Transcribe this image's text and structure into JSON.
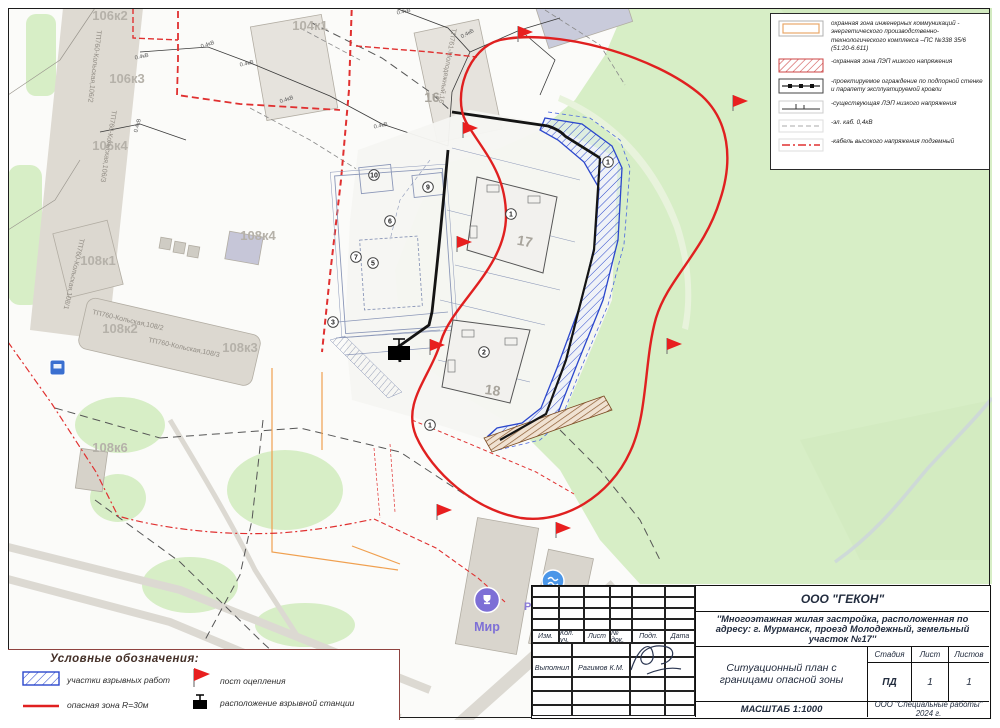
{
  "colors": {
    "danger_zone_red": "#e02020",
    "blast_area_blue": "#2b47cc",
    "park_green": "#d7eec6",
    "map_label_grey": "#b5b1a9"
  },
  "legend_top": {
    "items": [
      {
        "symbol": "utility-protection-zone",
        "label": "охранная зона инженерных коммуникаций - энергетического производственно-технологического комплекса –ПС №338 35/6 (51:20-6.611)"
      },
      {
        "symbol": "lep-low-voltage-zone",
        "label": "-охранная зона ЛЭП низкого напряжения"
      },
      {
        "symbol": "designed-fence",
        "label": "-проектируемое ограждение по подпорной стенке и парапету эксплуатируемой кровли"
      },
      {
        "symbol": "existing-lep",
        "label": "-существующая ЛЭП низкого напряжения"
      },
      {
        "symbol": "el-cable",
        "label": "-эл. каб. 0,4кВ"
      },
      {
        "symbol": "hv-underground-cable",
        "label": "-кабель высокого напряжения подземный"
      }
    ]
  },
  "legend_bottom": {
    "title": "Условные обозначения:",
    "items": [
      {
        "symbol": "blast-work-area",
        "label": "участки взрывных работ"
      },
      {
        "symbol": "danger-zone-line",
        "label": "опасная зона R=30м"
      },
      {
        "symbol": "cordon-post-flag",
        "label": "пост оцепления"
      },
      {
        "symbol": "blast-station",
        "label": "расположение взрывной станции"
      }
    ]
  },
  "title_block": {
    "org": "ООО \"ГЕКОН\"",
    "project": "''Многоэтажная жилая застройка, расположенная по адресу: г. Мурманск, проезд Молодежный, земельный участок №17''",
    "doc_title": "Ситуационный план с границами опасной зоны",
    "scale": "МАСШТАБ 1:1000",
    "company": "ООО \"Специальные работы\"\n2024 г.",
    "stage_label": "Стадия",
    "sheet_label": "Лист",
    "sheets_label": "Листов",
    "stage": "ПД",
    "sheet": "1",
    "sheets": "1",
    "columns": [
      "Изм.",
      "Кол. уч.",
      "Лист",
      "№ док.",
      "Подп.",
      "Дата"
    ],
    "performed_label": "Выполнил",
    "performed_name": "Рагимов К.М."
  },
  "map": {
    "building_labels": [
      "106к2",
      "106к3",
      "106к4",
      "104к1",
      "108к1",
      "108к2",
      "108к3",
      "108к4",
      "108к6",
      "16",
      "17",
      "18"
    ],
    "street_labels": [
      "ТП760-Кольская,106/2",
      "ТП760-Кольская,106/3",
      "ТП760-Кольская,108/1",
      "ТП760-Кольская,108/2",
      "ТП760-Кольская,108/3",
      "ТП761-Молодежный,16"
    ],
    "voltage_label": "0.4кВ",
    "circled": [
      "10",
      "9",
      "6",
      "7",
      "5",
      "3",
      "1",
      "2",
      "1",
      "1"
    ],
    "poi": {
      "mir": "Мир",
      "r": "Р"
    }
  }
}
